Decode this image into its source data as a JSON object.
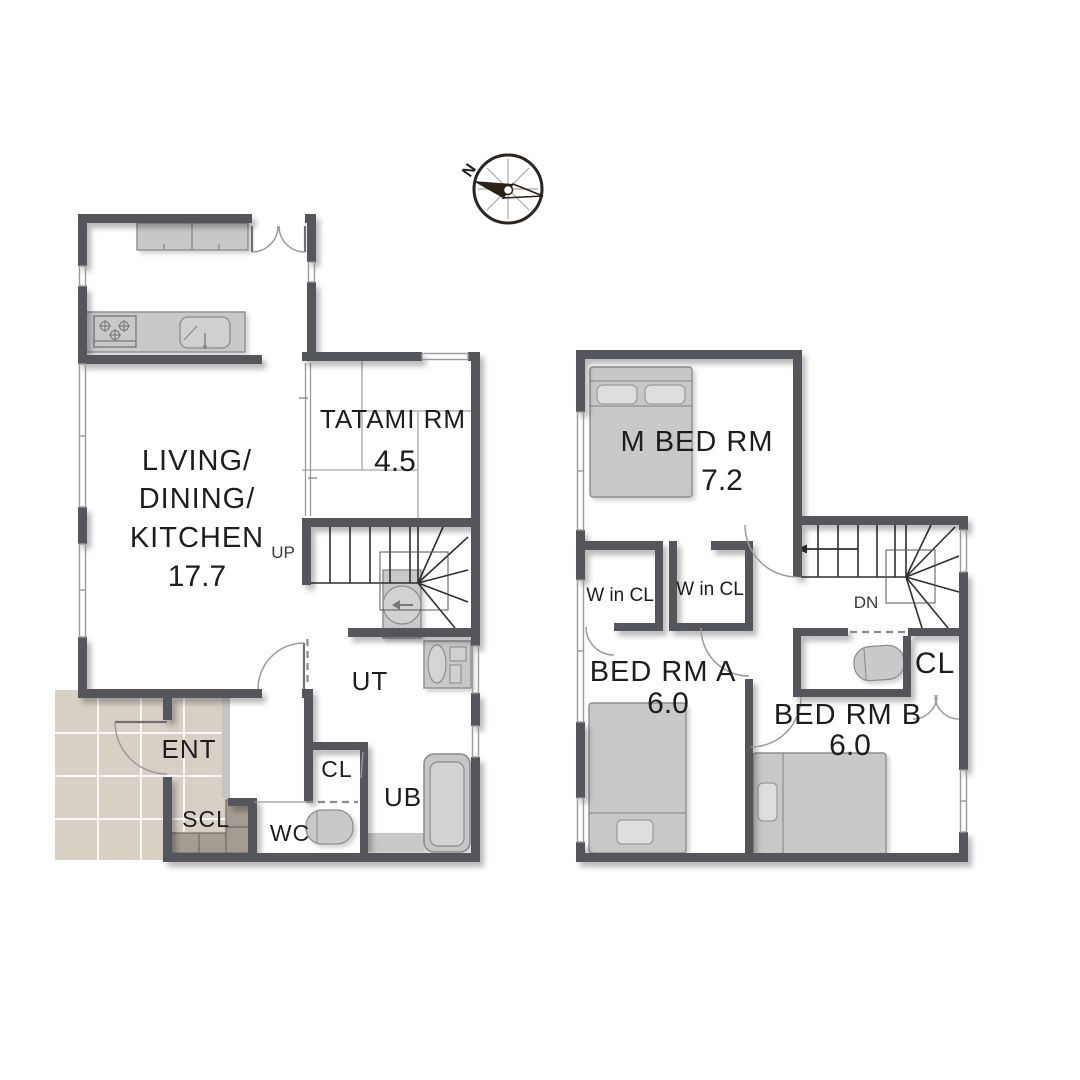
{
  "compass": {
    "north_label": "N"
  },
  "first_floor": {
    "living_dining_kitchen": {
      "label_lines": [
        "LIVING/",
        "DINING/",
        "KITCHEN"
      ],
      "area": "17.7"
    },
    "tatami_room": {
      "label": "TATAMI RM",
      "area": "4.5"
    },
    "stairs_label": "UP",
    "utility_label": "UT",
    "closet_label": "CL",
    "toilet_label": "WC",
    "bath_label": "UB",
    "entrance_label": "ENT",
    "shoe_closet_label": "SCL"
  },
  "second_floor": {
    "master_bedroom": {
      "label": "M BED RM",
      "area": "7.2"
    },
    "walk_in_closet_left_label": "W in CL",
    "walk_in_closet_right_label": "W in CL",
    "stairs_label": "DN",
    "bedroom_a": {
      "label": "BED RM A",
      "area": "6.0"
    },
    "bedroom_b": {
      "label": "BED RM B",
      "area": "6.0"
    },
    "closet_label": "CL"
  },
  "colors": {
    "wall": "#55555b",
    "fixture_fill": "#c8c8c8",
    "fixture_stroke": "#8e8e8e",
    "entrance_tile": "#d8d0c4",
    "shoe_cabinet": "#a49c92",
    "text": "#1d1d1f"
  }
}
